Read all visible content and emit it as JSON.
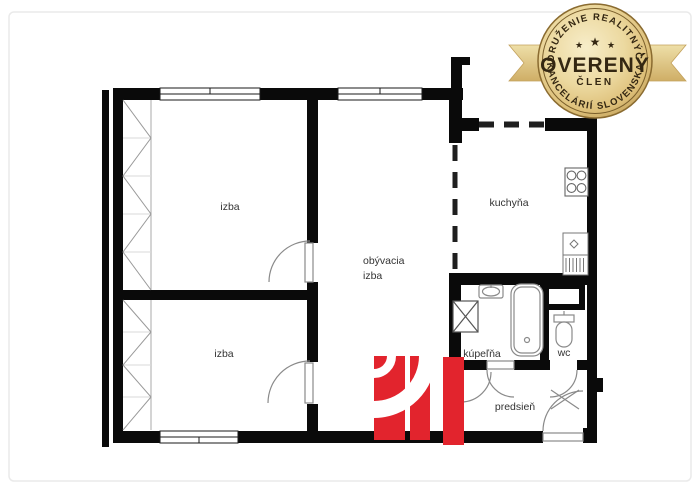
{
  "page": {
    "background": "#ffffff",
    "frame_border_color": "#eaeaea"
  },
  "floor_plan": {
    "wall_color": "#0a0a0a",
    "thin_line_color": "#8a8a8a",
    "rooms": [
      {
        "name": "room-top-left",
        "label": "izba"
      },
      {
        "name": "room-bottom-left",
        "label": "izba"
      },
      {
        "name": "living-room",
        "label_line1": "obývacia",
        "label_line2": "izba"
      },
      {
        "name": "kitchen",
        "label": "kuchyňa"
      },
      {
        "name": "bathroom",
        "label": "kúpeľňa"
      },
      {
        "name": "wc",
        "label": "wc"
      },
      {
        "name": "hallway",
        "label": "predsieň"
      }
    ]
  },
  "logo": {
    "color": "#e2242d"
  },
  "badge": {
    "arc_top": "ZDRUŽENIE REALITNÝCH",
    "title": "OVERENÝ",
    "subtitle": "ČLEN",
    "arc_bottom": "KANCELÁRIÍ SLOVENSKA",
    "star": "★",
    "gold_base": "#d9bc7c",
    "gold_light": "#f6ecc8",
    "gold_dark": "#a9843f",
    "text_color": "#342712"
  }
}
